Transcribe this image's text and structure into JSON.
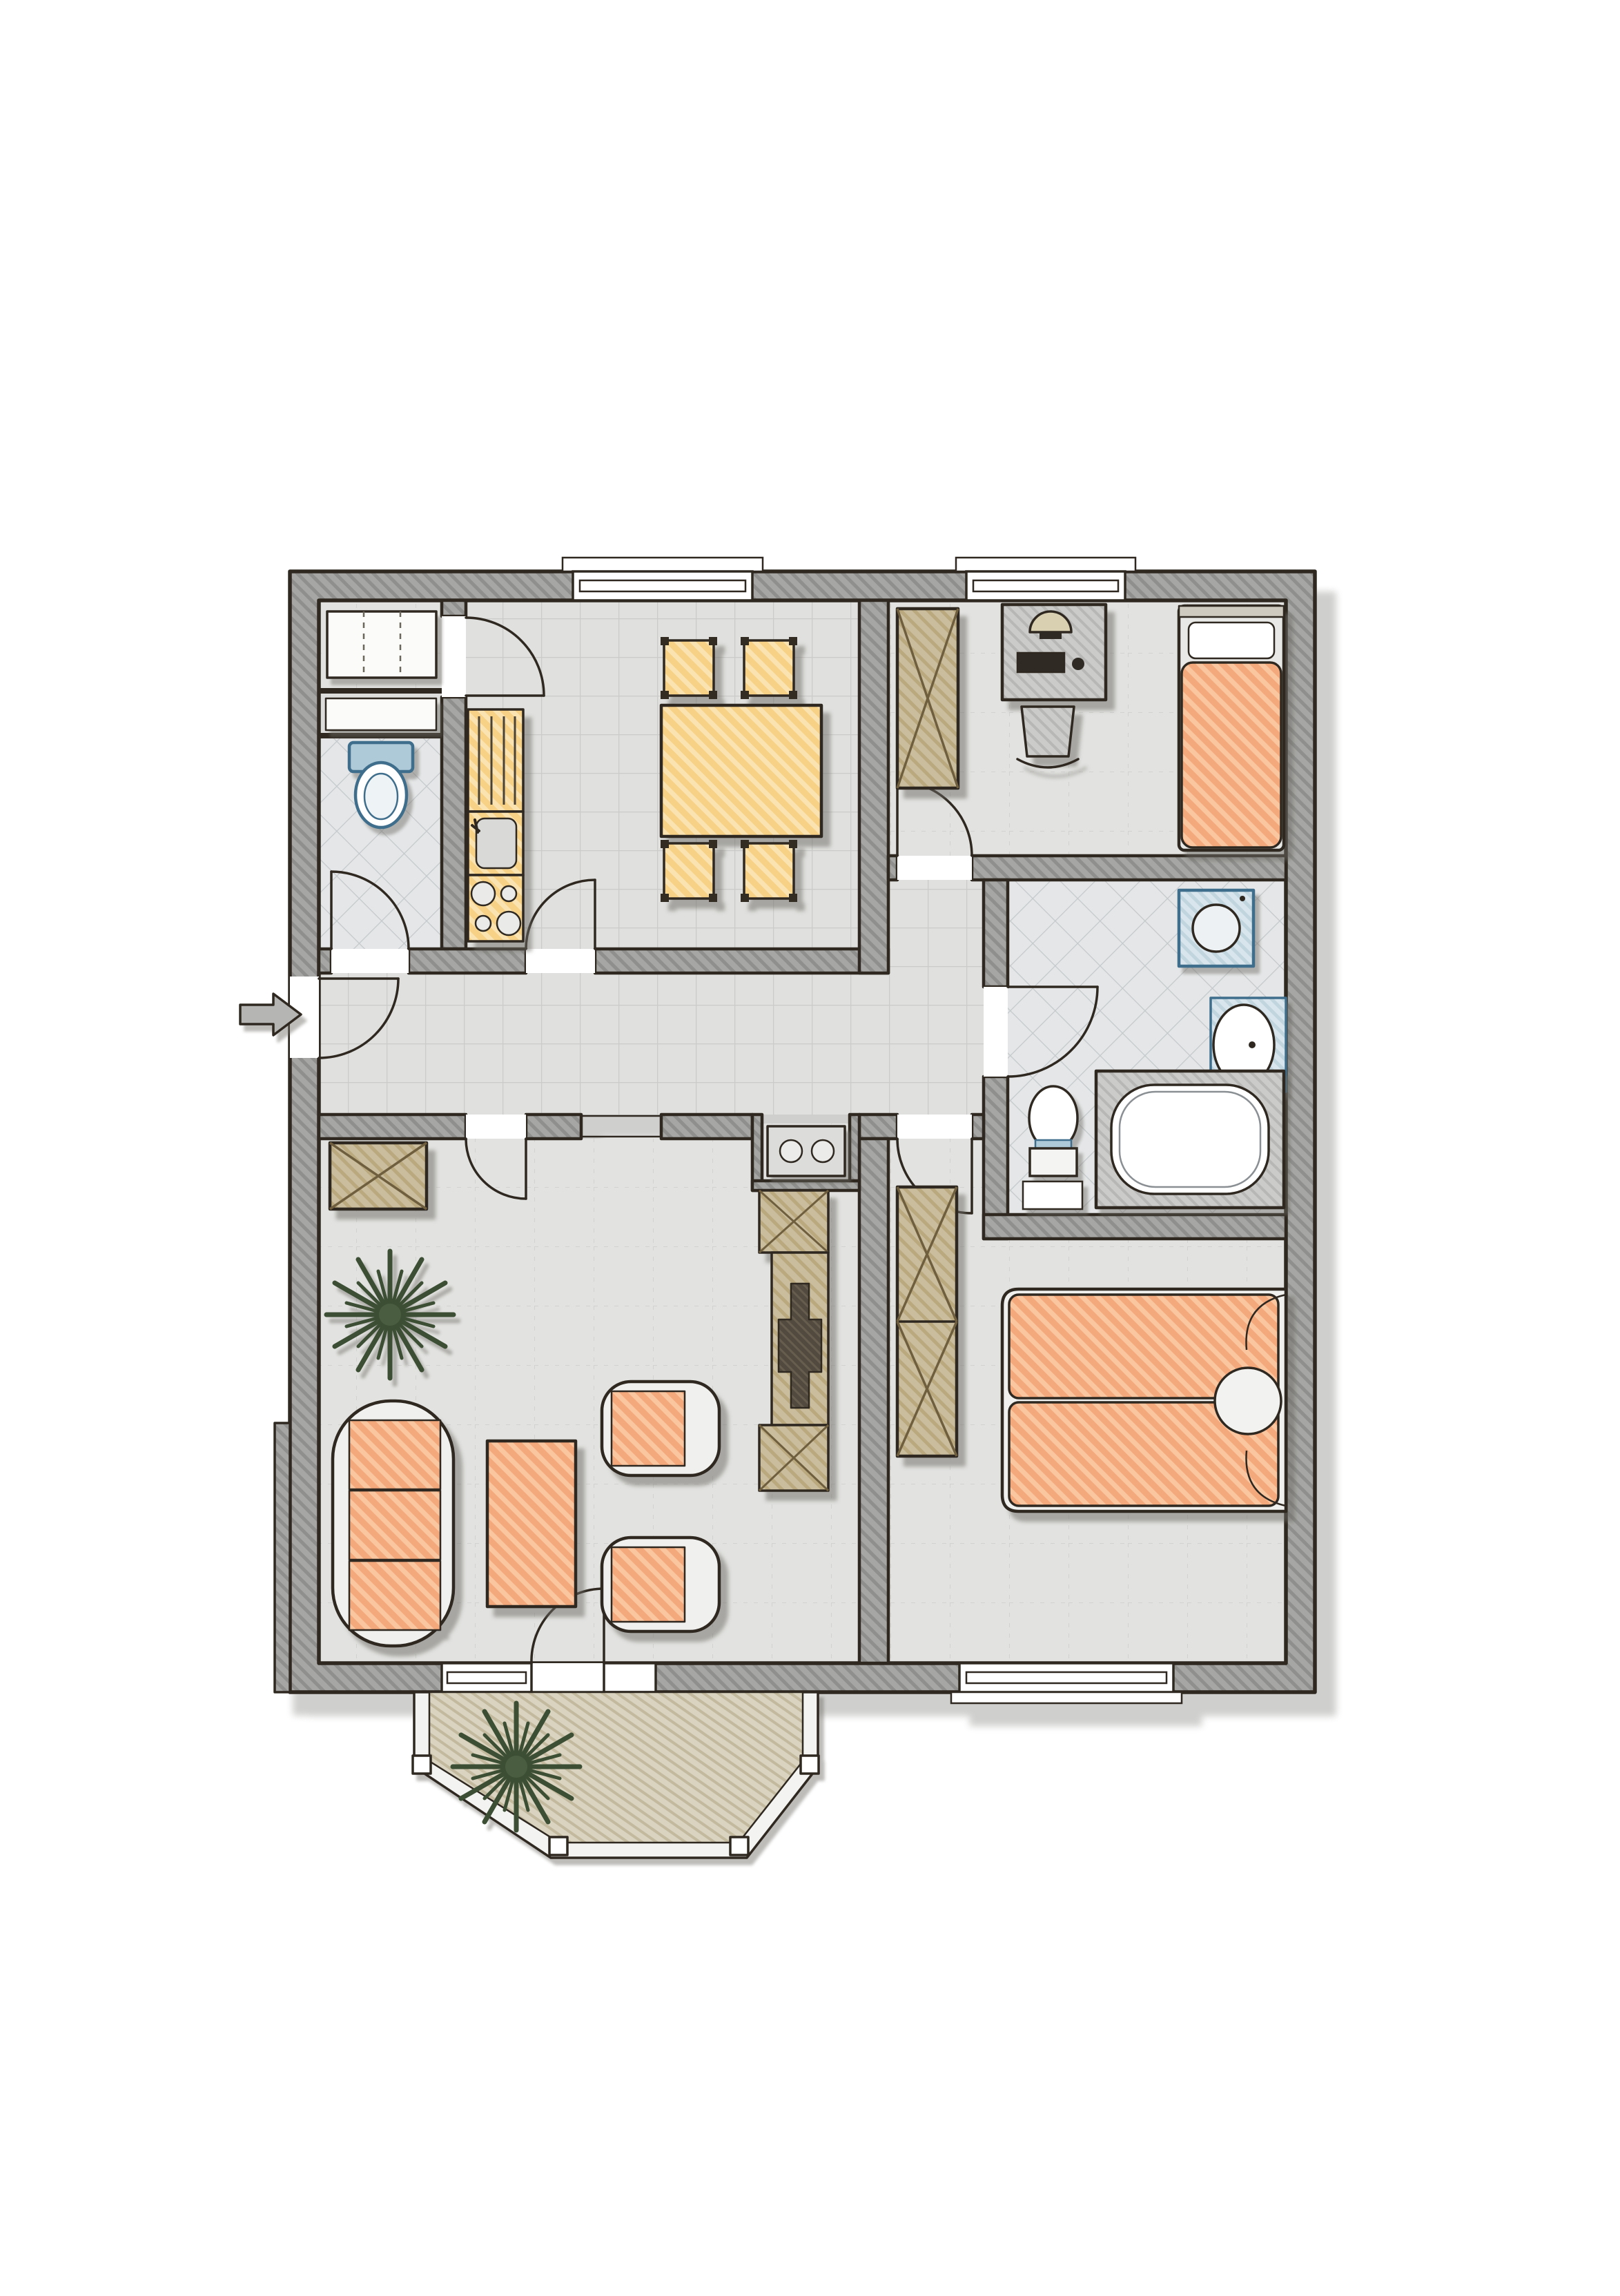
{
  "document": {
    "type": "floor-plan",
    "title": "Apartment floor plan",
    "style": "hand-drawn colored architectural sketch, top view",
    "text_labels_visible": "none"
  },
  "palette": {
    "paper": "#ffffff",
    "wall_fill": "#a6a6a4",
    "wall_hatch_line": "#8f8f8d",
    "outline_dark": "#2e2820",
    "floor_plain": "#e2e2e0",
    "floor_tile": "#e0e0de",
    "floor_wet": "#e4e6e7",
    "balcony_floor": "#d9d3bf",
    "furniture_orange": "#f4a97c",
    "furniture_orange_stripe": "#f9c6a0",
    "furniture_yellow": "#f6d186",
    "furniture_yellow_stripe": "#fae3b0",
    "cabinet_wood": "#c9bd9d",
    "cabinet_wood_stripe": "#baa87e",
    "fixture_blue": "#3f6e8c",
    "fixture_blue_fill": "#d9e5ec",
    "plant_green": "#3c4f34",
    "desk_gray": "#cbcbc9",
    "tv_dark": "#524a3e",
    "arrow_gray": "#b5b5b3",
    "shadow": "rgba(108,106,100,0.5)"
  },
  "entrance": {
    "marker": "block-arrow",
    "direction": "right",
    "location": "left exterior wall into hallway"
  },
  "rooms": [
    {
      "id": "storage",
      "name": "Storage room",
      "position": "top-left",
      "furniture": [
        "shelf-cabinet"
      ],
      "doors": [
        "to kitchen"
      ],
      "windows": 0
    },
    {
      "id": "wc",
      "name": "WC",
      "position": "left, below storage",
      "furniture": [
        "toilet",
        "wall-niche-shelf"
      ],
      "doors": [
        "to hallway"
      ],
      "windows": 0
    },
    {
      "id": "kitchen",
      "name": "Kitchen / dining room",
      "position": "top-center",
      "furniture": [
        "kitchen-cabinet",
        "kitchen-sink",
        "stove-4-burners",
        "dining-table",
        "dining-chair x4"
      ],
      "doors": [
        "to hallway",
        "to storage"
      ],
      "windows": 1
    },
    {
      "id": "bedroom-1",
      "name": "Bedroom / study",
      "position": "top-right",
      "furniture": [
        "wardrobe",
        "desk",
        "monitor",
        "keyboard",
        "mouse",
        "desk-chair",
        "single-bed"
      ],
      "doors": [
        "to hallway"
      ],
      "windows": 1
    },
    {
      "id": "hallway",
      "name": "Hallway",
      "position": "center band",
      "furniture": [],
      "doors": [
        "entrance",
        "wc",
        "kitchen",
        "living-room",
        "bedroom-1",
        "bedroom-2",
        "bathroom",
        "open passage to living room"
      ],
      "windows": 0
    },
    {
      "id": "bathroom",
      "name": "Bathroom",
      "position": "middle-right",
      "furniture": [
        "washing-machine",
        "washbasin",
        "toilet",
        "bathtub"
      ],
      "doors": [
        "to hallway"
      ],
      "windows": 0
    },
    {
      "id": "living-room",
      "name": "Living room",
      "position": "bottom-left",
      "furniture": [
        "wardrobe-cabinet",
        "potted-plant",
        "sofa-3-seater",
        "coffee-table",
        "armchair x2",
        "sideboard-in-alcove",
        "shelf-column-with-tv",
        "cabinet x2"
      ],
      "doors": [
        "to balcony"
      ],
      "windows": 1
    },
    {
      "id": "bedroom-2",
      "name": "Bedroom",
      "position": "bottom-right",
      "furniture": [
        "wardrobe-2-sections",
        "double-bed",
        "round-pillow"
      ],
      "doors": [
        "to hallway"
      ],
      "windows": 1
    },
    {
      "id": "balcony",
      "name": "Balcony",
      "position": "bottom, octagonal bay",
      "furniture": [
        "potted-plant"
      ],
      "railing": true,
      "windows": 0
    }
  ]
}
